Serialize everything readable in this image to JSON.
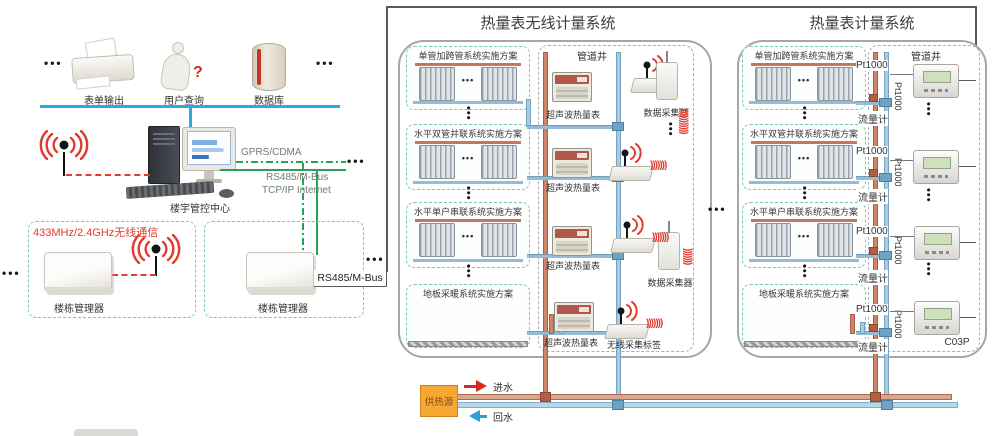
{
  "misc": {
    "dots": "•••",
    "coil": ")))))))",
    "coil_long": ")))))))))))"
  },
  "left": {
    "top": {
      "dots_left": "•••",
      "dots_right": "•••",
      "items": [
        {
          "label": "表单输出"
        },
        {
          "label": "用户查询",
          "mark": "?"
        },
        {
          "label": "数据库"
        }
      ]
    },
    "center": {
      "label": "楼宇管控中心"
    },
    "links": {
      "gprs": "GPRS/CDMA",
      "rs485": "RS485/M-Bus",
      "tcpip": "TCP/IP Internet",
      "dots": "•••"
    },
    "wireless_note": "433MHz/2.4GHz无线通信",
    "managers": [
      {
        "label": "楼栋管理器"
      },
      {
        "label": "楼栋管理器"
      }
    ],
    "bus_label": "RS485/M-Bus",
    "dots_left": "•••",
    "dots_right": "•••"
  },
  "between_dots": "•••",
  "panel_wireless": {
    "title": "热量表无线计量系统",
    "shaft_label": "管道井",
    "schemes": [
      {
        "label": "单管加跨管系统实施方案"
      },
      {
        "label": "水平双管并联系统实施方案"
      },
      {
        "label": "水平单户串联系统实施方案"
      },
      {
        "label": "地板采暖系统实施方案"
      }
    ],
    "meter_label": "超声波热量表",
    "collector_label": "数据采集器",
    "tag_label": "无线采集标签"
  },
  "panel_wired": {
    "title": "热量表计量系统",
    "shaft_label": "管道井",
    "schemes": [
      {
        "label": "单管加跨管系统实施方案"
      },
      {
        "label": "水平双管并联系统实施方案"
      },
      {
        "label": "水平单户串联系统实施方案"
      },
      {
        "label": "地板采暖系统实施方案"
      }
    ],
    "pt1000_label": "Pt1000",
    "flow_meter_label": "流量计",
    "device_model": "C03P"
  },
  "bottom": {
    "heat_source": "供热源",
    "supply": "进水",
    "return": "回水"
  },
  "colors": {
    "supply_pipe": "#c87f62",
    "return_pipe": "#8fbcd6",
    "wireless_red": "#e23b2e",
    "network_green": "#2aa05c",
    "lan_blue": "#29abe2",
    "heat_source_orange": "#f6a832"
  }
}
